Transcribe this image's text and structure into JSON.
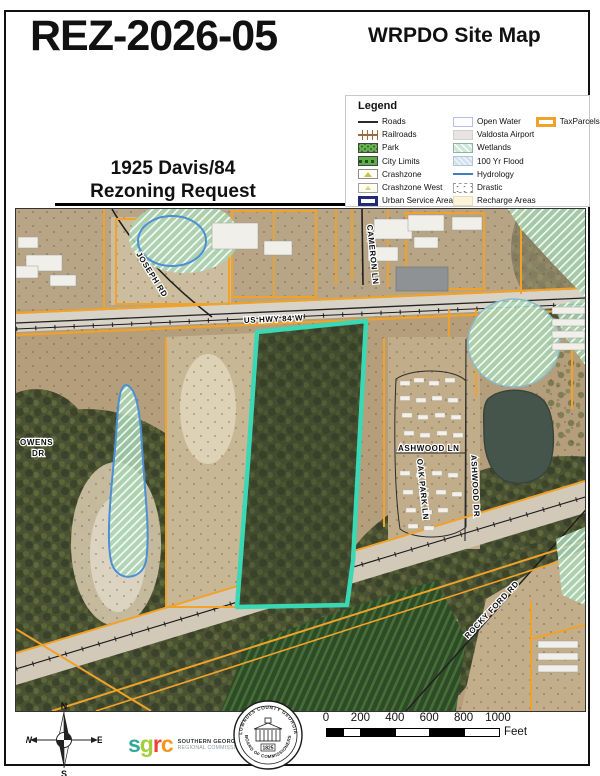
{
  "header": {
    "case_number": "REZ-2026-05",
    "map_title": "WRPDO Site Map"
  },
  "subtitle": {
    "line1": "1925 Davis/84",
    "line2": "Rezoning Request"
  },
  "legend": {
    "title": "Legend",
    "col1": [
      "Roads",
      "Railroads",
      "Park",
      "City Limits",
      "Crashzone",
      "Crashzone West",
      "Urban Service Area"
    ],
    "col2": [
      "Open Water",
      "Valdosta Airport",
      "Wetlands",
      "100 Yr Flood",
      "Hydrology",
      "Drastic",
      "Recharge Areas"
    ],
    "col3": [
      "TaxParcels"
    ]
  },
  "map": {
    "labels": {
      "joseph_rd": "JOSEPH RD",
      "us_hwy_84": "US HWY 84 W",
      "cameron_ln": "CAMERON LN",
      "owens_dr_line1": "OWENS",
      "owens_dr_line2": "DR",
      "oak_park_ln": "OAK PARK LN",
      "ashwood_ln": "ASHWOOD LN",
      "ashwood_dr": "ASHWOOD DR",
      "rocky_ford_rd": "ROCKY FORD RD"
    },
    "colors": {
      "highlight_parcel": "#3ad9b6",
      "tax_parcel_lines": "#f0a22a",
      "hydrology_blue": "#4b8fd4"
    }
  },
  "footer": {
    "compass": {
      "n": "N",
      "s": "S",
      "e": "E",
      "w": "W"
    },
    "sgrc": {
      "letters": [
        "s",
        "g",
        "r",
        "c"
      ],
      "letter_colors": [
        "#35a79c",
        "#a6ce39",
        "#ee4036",
        "#f7941e"
      ],
      "org_line1": "SOUTHERN GEORGIA",
      "org_line2": "REGIONAL COMMISSION"
    },
    "seal": {
      "arc_top": "LOWNDES COUNTY GEORGIA",
      "arc_bottom": "BOARD OF COMMISSIONERS",
      "year": "1825"
    },
    "scalebar": {
      "ticks": [
        "0",
        "200",
        "400",
        "600",
        "800",
        "1000"
      ],
      "unit": "Feet"
    }
  }
}
